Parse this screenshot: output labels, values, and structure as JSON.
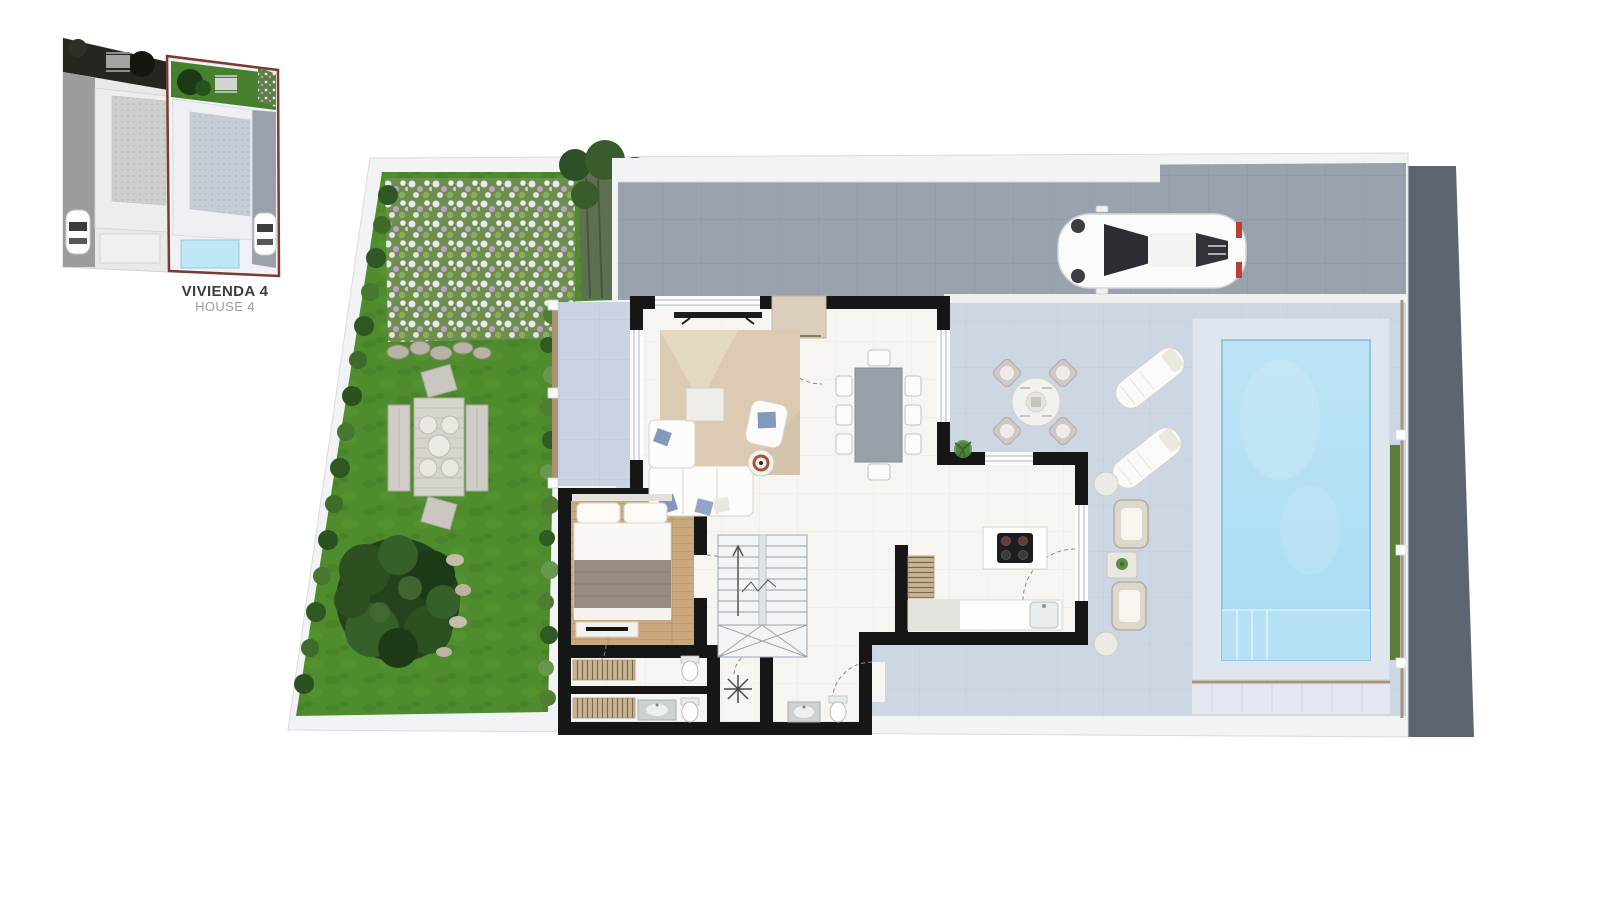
{
  "inset": {
    "title": "VIVIENDA 4",
    "subtitle": "HOUSE 4"
  },
  "colors": {
    "highlight": "#7c3a31",
    "grass": "#4e8c2e",
    "grass_dark": "#3f7a24",
    "driveway": "#9aa2ae",
    "street": "#5d6570",
    "terrace": "#cdd6e3",
    "porch": "#c9d3e2",
    "pool": "#aadcf2",
    "pool_deck": "#e0e6ef",
    "wall": "#161616",
    "floor": "#f7f5f1",
    "wood_floor": "#c9a87e",
    "rug": "#dccbb2",
    "hedge": "#2e5722",
    "fence_wood": "#ab9271",
    "title_color": "#3d3d3d",
    "subtitle_color": "#9b9b9b"
  }
}
